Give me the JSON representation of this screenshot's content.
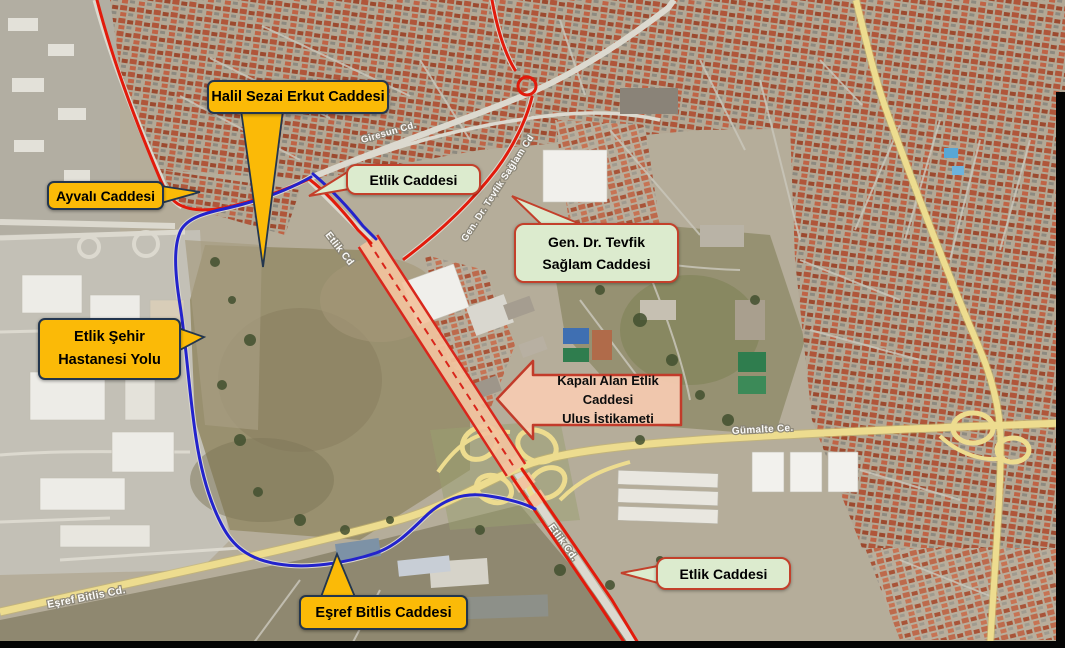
{
  "map": {
    "callouts": {
      "halil": {
        "label": "Halil Sezai Erkut Caddesi",
        "style": "yellow"
      },
      "ayvali": {
        "label": "Ayvalı Caddesi",
        "style": "yellow"
      },
      "etlik_top": {
        "label": "Etlik Caddesi",
        "style": "green"
      },
      "tevfik": {
        "line1": "Gen. Dr. Tevfik",
        "line2": "Sağlam Caddesi",
        "style": "green"
      },
      "hastane": {
        "line1": "Etlik Şehir",
        "line2": "Hastanesi Yolu",
        "style": "yellow"
      },
      "kapali": {
        "line1": "Kapalı Alan Etlik Caddesi",
        "line2": "Ulus İstikameti",
        "style": "salmon-arrow"
      },
      "etlik_bottom": {
        "label": "Etlik Caddesi",
        "style": "green"
      },
      "esref": {
        "label": "Eşref Bitlis Caddesi",
        "style": "yellow"
      }
    },
    "street_labels": {
      "giresun": "Giresun Cd.",
      "tevfik_road": "Gen. Dr. Tevfik Sağlam Cd",
      "etlik_upper": "Etlik Cd",
      "gumalte": "Gümalte Ce.",
      "etlik_lower": "Etlik Cd.",
      "esref_road": "Eşref Bitlis Cd."
    },
    "colors": {
      "callout_yellow": "#FBBA07",
      "callout_yellow_border": "#23364E",
      "callout_green": "#DCEBCE",
      "callout_green_border": "#C3402B",
      "closed_area_arrow_fill": "#F6CBB1",
      "closed_area_arrow_border": "#C23B2A",
      "route_red": "#E21B0C",
      "route_blue": "#2323CC",
      "closed_corridor_fill": "#F2C39E",
      "major_road_yellow": "#EDDC8F"
    }
  }
}
